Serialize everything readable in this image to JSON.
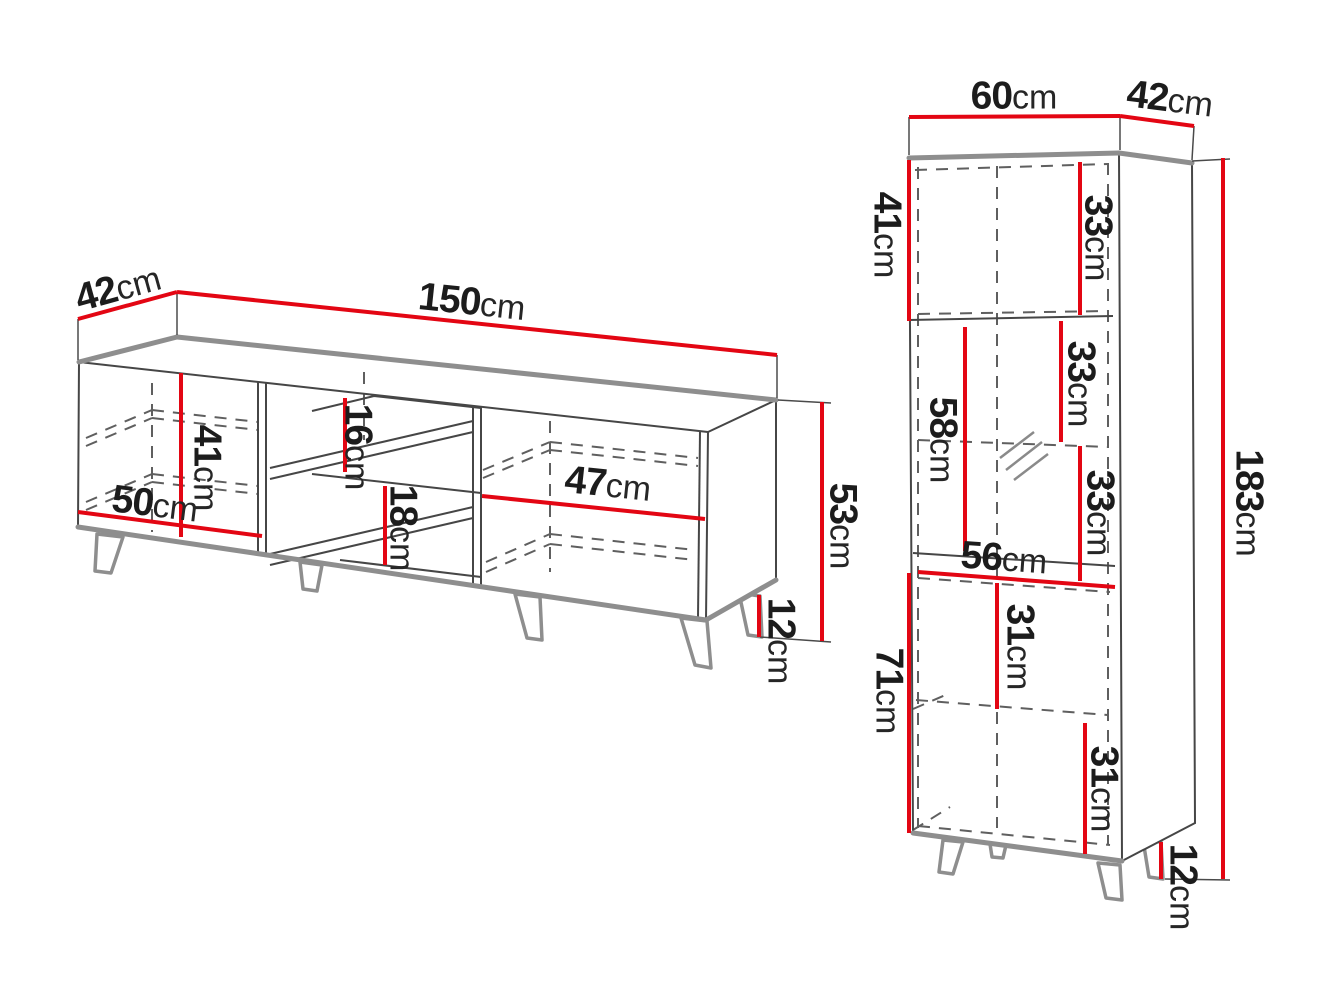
{
  "diagram_title": "furniture dimension drawing",
  "unit": "cm",
  "colors": {
    "dimension_line_red": "#e30613",
    "outline_gray": "#8e8e8e",
    "line_dark": "#464646",
    "dashed_gray": "#5f5f5f",
    "text": "#1c1c1c",
    "background": "#ffffff"
  },
  "tv_stand": {
    "name": "tv-stand",
    "dims": {
      "depth": {
        "value": "42",
        "unit": "cm"
      },
      "width": {
        "value": "150",
        "unit": "cm"
      },
      "inner_height": {
        "value": "41",
        "unit": "cm"
      },
      "left_door_width": {
        "value": "50",
        "unit": "cm"
      },
      "shelf_upper": {
        "value": "16",
        "unit": "cm"
      },
      "shelf_lower": {
        "value": "18",
        "unit": "cm"
      },
      "right_comp_width": {
        "value": "47",
        "unit": "cm"
      },
      "body_height": {
        "value": "53",
        "unit": "cm"
      },
      "leg_height": {
        "value": "12",
        "unit": "cm"
      }
    }
  },
  "display_cabinet": {
    "name": "tall-display-cabinet",
    "dims": {
      "width": {
        "value": "60",
        "unit": "cm"
      },
      "depth": {
        "value": "42",
        "unit": "cm"
      },
      "top_section_height": {
        "value": "41",
        "unit": "cm"
      },
      "shelf_1": {
        "value": "33",
        "unit": "cm"
      },
      "shelf_2": {
        "value": "33",
        "unit": "cm"
      },
      "shelf_3": {
        "value": "33",
        "unit": "cm"
      },
      "glass_door_height": {
        "value": "58",
        "unit": "cm"
      },
      "lower_width": {
        "value": "56",
        "unit": "cm"
      },
      "lower_shelf_1": {
        "value": "31",
        "unit": "cm"
      },
      "lower_shelf_2": {
        "value": "31",
        "unit": "cm"
      },
      "lower_height": {
        "value": "71",
        "unit": "cm"
      },
      "total_height": {
        "value": "183",
        "unit": "cm"
      },
      "leg_height": {
        "value": "12",
        "unit": "cm"
      }
    }
  }
}
